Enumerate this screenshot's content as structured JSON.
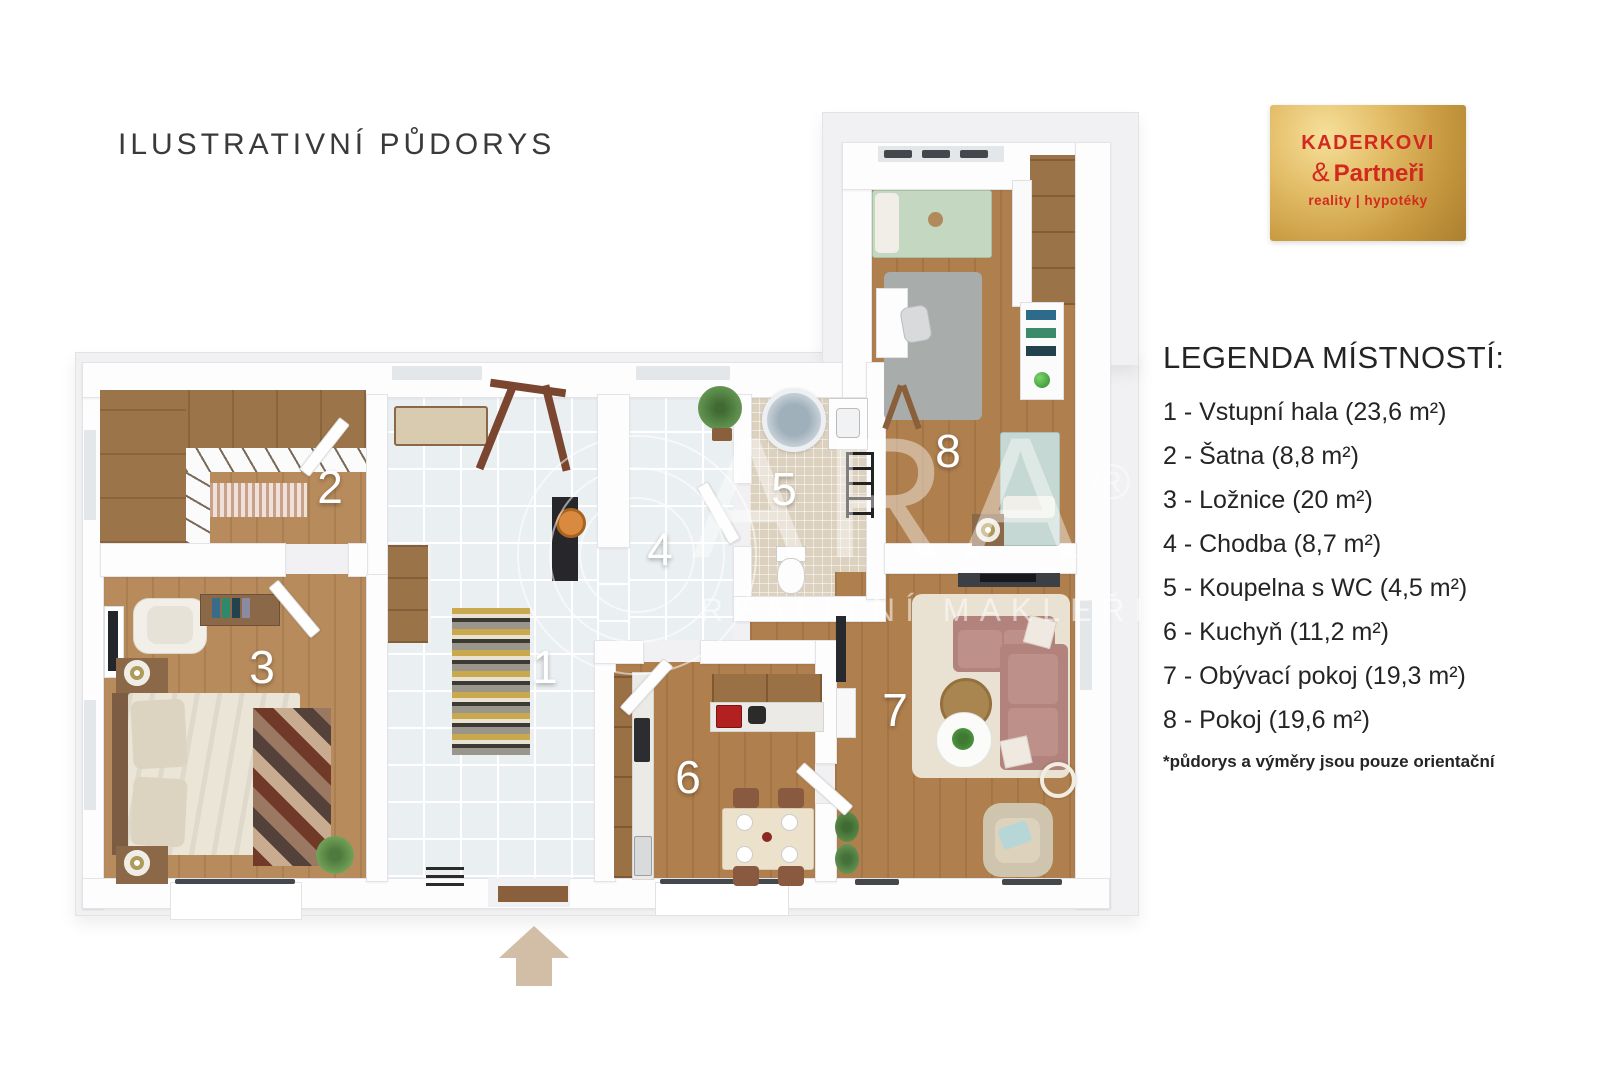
{
  "title": "ILUSTRATIVNÍ PŮDORYS",
  "logo": {
    "name": "KADERKOVI",
    "ampersand": "&",
    "partners": "Partneři",
    "tagline": "reality | hypotéky",
    "colors": {
      "gold": "#d7b05a",
      "red": "#d2291f"
    }
  },
  "legend": {
    "heading": "LEGENDA MÍSTNOSTÍ:",
    "items": [
      "1 - Vstupní hala (23,6 m²)",
      "2 - Šatna (8,8 m²)",
      "3 - Ložnice (20 m²)",
      "4 - Chodba (8,7 m²)",
      "5 - Koupelna s WC (4,5 m²)",
      "6 - Kuchyň (11,2 m²)",
      "7 - Obývací pokoj (19,3 m²)",
      "8 - Pokoj (19,6 m²)"
    ],
    "footnote": "*půdorys a výměry jsou pouze orientační"
  },
  "rooms": {
    "r1": "1",
    "r2": "2",
    "r3": "3",
    "r4": "4",
    "r5": "5",
    "r6": "6",
    "r7": "7",
    "r8": "8"
  },
  "watermark": {
    "brand": "ARA",
    "reg": "®",
    "subtitle": "REALITNÍ MAKLÉŘI"
  },
  "palette": {
    "wood_floor": "#b1824f",
    "tile_floor": "#eaeff1",
    "bath_floor": "#dcd1bf",
    "wall": "#fdfdfe",
    "platform": "#f1f1f3",
    "arrow": "#d2bda7",
    "sofa": "#b1837c",
    "living_rug": "#e9e1d1",
    "logo_red": "#d2291f"
  }
}
